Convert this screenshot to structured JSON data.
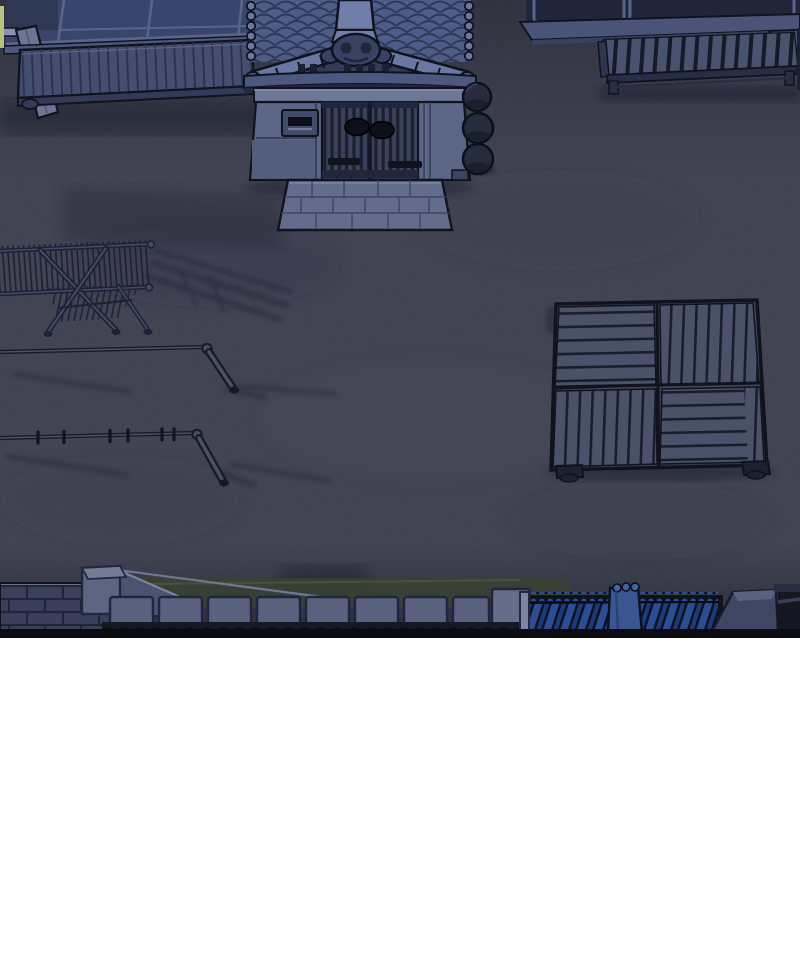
{
  "scene": {
    "type": "comic-panel-illustration",
    "setting": "night courtyard of a traditional Japanese house, overhead view",
    "objects": [
      {
        "name": "house-window-wall",
        "desc": "dark sliding windows over a wooden engawa deck, top-left"
      },
      {
        "name": "entrance-gate",
        "desc": "roofed gate with blue kawara tiles, barred double doors, mail slot, stone step"
      },
      {
        "name": "stone-spheres",
        "desc": "three dark round stones stacked beside the gate pillar"
      },
      {
        "name": "neighbor-building",
        "desc": "building band with windows, stone ledge and slatted bench, top-right"
      },
      {
        "name": "drying-rack",
        "desc": "folding ladder-style laundry rack on X legs, left side"
      },
      {
        "name": "laundry-poles",
        "desc": "two thin horizontal drying poles with diagonal support legs and clothespins"
      },
      {
        "name": "wood-pallet",
        "desc": "square slatted platform with four alternating plank quadrants, right side"
      },
      {
        "name": "boundary-wall",
        "desc": "brick wall, stone pillar, hedge, concrete panel fence, blue tile-topped wall, pillar cap along bottom"
      }
    ]
  },
  "palette": {
    "page_bg": "#ffffff",
    "ground": "#414456",
    "outline": "#10131e",
    "roof_tile": "#4e5c88",
    "roof_tile_line": "#2e3758",
    "ridge_cap": "#6a77a4",
    "ridge_panel": "#717ea9",
    "ornament": "#3a4263",
    "gable": "#333b58",
    "eave": "#4d5880",
    "eave_shadow": "#232841",
    "gate_frame": "#6d7796",
    "gate_pillar": "#5b6585",
    "gate_door_bg": "#3a415c",
    "gate_bar": "#1a1f2e",
    "gate_hardware": "#0d1019",
    "stone_step": "#636c8b",
    "stone_step_line": "#3e4565",
    "sphere": "#262b3d",
    "window_glass": "#39456a",
    "window_glass_dark": "#20253a",
    "window_frame": "#59648c",
    "sill": "#4e587c",
    "post": "#6c7694",
    "deck_wood": "#454e70",
    "deck_line": "#2a3048",
    "deck_front": "#323a58",
    "wall_ledge": "#4b5478",
    "bench_slat": "#49536e",
    "bench_dark": "#272d45",
    "rack_line": "#1c2134",
    "rack_core": "#434a68",
    "pole_dark": "#161a26",
    "pole_core": "#4a5066",
    "pallet_plank": "#4a5269",
    "pallet_gap": "#191d2b",
    "pallet_frame": "#3a425c",
    "brick": "#3a405a",
    "brick_joint": "#1f2438",
    "panel_wall": "#59617e",
    "hedge": "#3a4233",
    "fence_blue": "#2c4d94",
    "fence_blue_dark": "#1e3a74",
    "fence_bg": "#11141f",
    "pillar_cap": "#3f4662",
    "pillar_cap_top": "#596180",
    "bottom_band": "#0a0c12",
    "accent_sliver": "#b7c17e"
  }
}
